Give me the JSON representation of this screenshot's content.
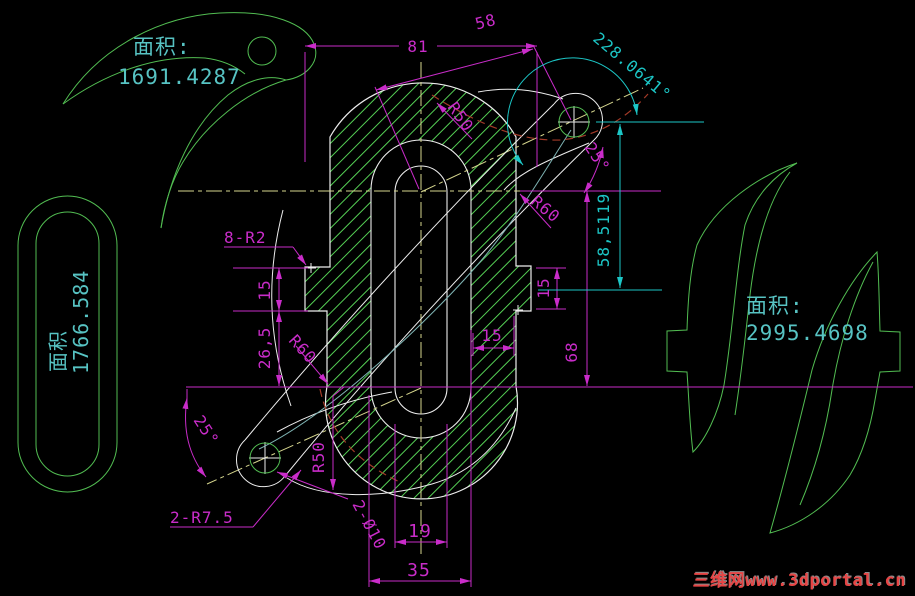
{
  "colors": {
    "background": "#000000",
    "shape_green": "#52bd52",
    "hatch_green": "#55d055",
    "dimension_magenta": "#c92cc9",
    "dimension_cyan": "#1cc6c6",
    "area_text_cyan": "#57c3c3",
    "outline_white": "#ededed",
    "centerline_yellow": "#d6d68e",
    "pitch_dark_red": "#a33a28",
    "spline_teal": "#7fb4b4",
    "watermark_red": "#e64545"
  },
  "areas": {
    "claw": {
      "label": "面积:",
      "value": "1691.4287"
    },
    "slot": {
      "label": "面积",
      "value": "1766.584"
    },
    "blades": {
      "label": "面积:",
      "value": "2995.4698"
    }
  },
  "dimensions": {
    "top_width": "81",
    "arm_length": "58",
    "arc_angle": "228.0641°",
    "top_angle": "25°",
    "radius_r50_top": "R50",
    "radius_r60_top": "R60",
    "height_585119": "58,5119",
    "fillet_note": "8-R2",
    "left_step_15": "15",
    "left_265": "26,5",
    "radius_r60_bottom": "R60",
    "radius_r50_bottom": "R50",
    "bottom_angle": "25°",
    "fillet_2r75": "2-R7.5",
    "holes_2d10": "2-Ø10",
    "right_width_15": "15",
    "right_step_15": "15",
    "right_height_68": "68",
    "slot_width_19": "19",
    "boss_width_35": "35"
  },
  "watermark": {
    "text": "三维网www.3dportal.cn"
  }
}
